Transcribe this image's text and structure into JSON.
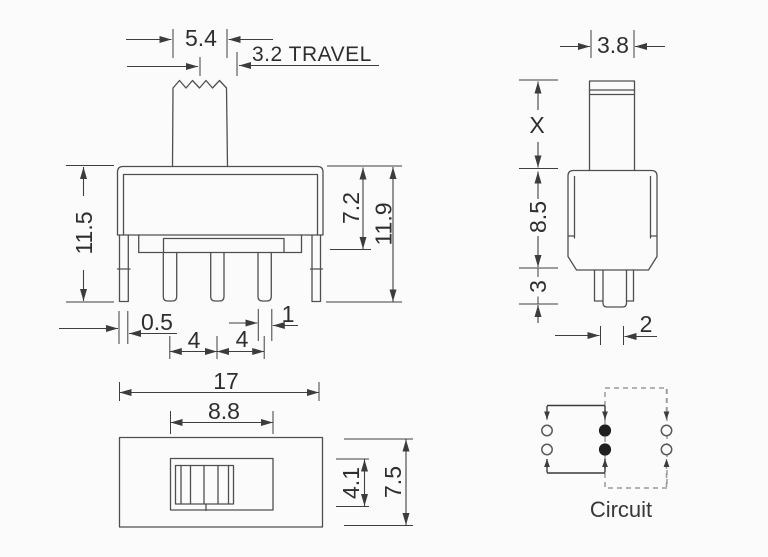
{
  "drawing": {
    "front_view": {
      "knob_width": "5.4",
      "travel": "3.2 TRAVEL",
      "height_overall_left": "11.5",
      "body_height": "7.2",
      "height_overall_right": "11.9",
      "leg_thickness": "0.5",
      "pin_pitch_left": "4",
      "pin_pitch_right": "4",
      "pin_width": "1"
    },
    "side_view": {
      "stem_width": "3.8",
      "stem_height": "X",
      "body_height": "8.5",
      "pin_length": "3",
      "pin_width": "2"
    },
    "bottom_view": {
      "body_length": "17",
      "slot_length": "8.8",
      "slot_width": "4.1",
      "body_width": "7.5"
    },
    "circuit": {
      "caption": "Circuit"
    },
    "colors": {
      "line": "#4f4f4f",
      "dimension": "#3f3f3f",
      "dashed": "#9b9b9b",
      "text": "#2e2e2e",
      "background": "#fbfbfb"
    }
  }
}
